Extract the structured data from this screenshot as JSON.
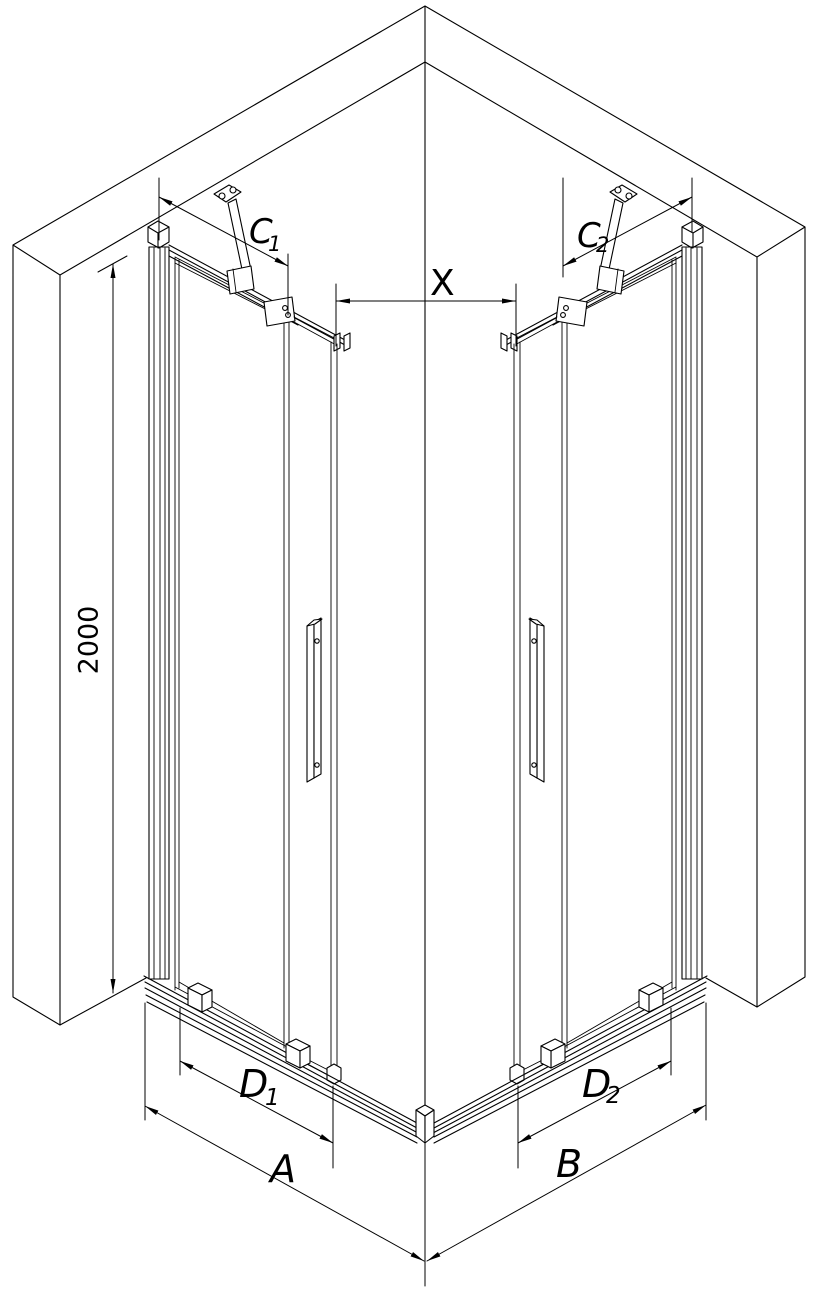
{
  "diagram": {
    "type": "technical-drawing-isometric",
    "background_color": "#ffffff",
    "line_color": "#000000"
  },
  "labels": {
    "height": "2000",
    "opening": "X",
    "c1": {
      "main": "C",
      "sub": "1"
    },
    "c2": {
      "main": "C",
      "sub": "2"
    },
    "d1": {
      "main": "D",
      "sub": "1"
    },
    "d2": {
      "main": "D",
      "sub": "2"
    },
    "a": "A",
    "b": "B"
  }
}
